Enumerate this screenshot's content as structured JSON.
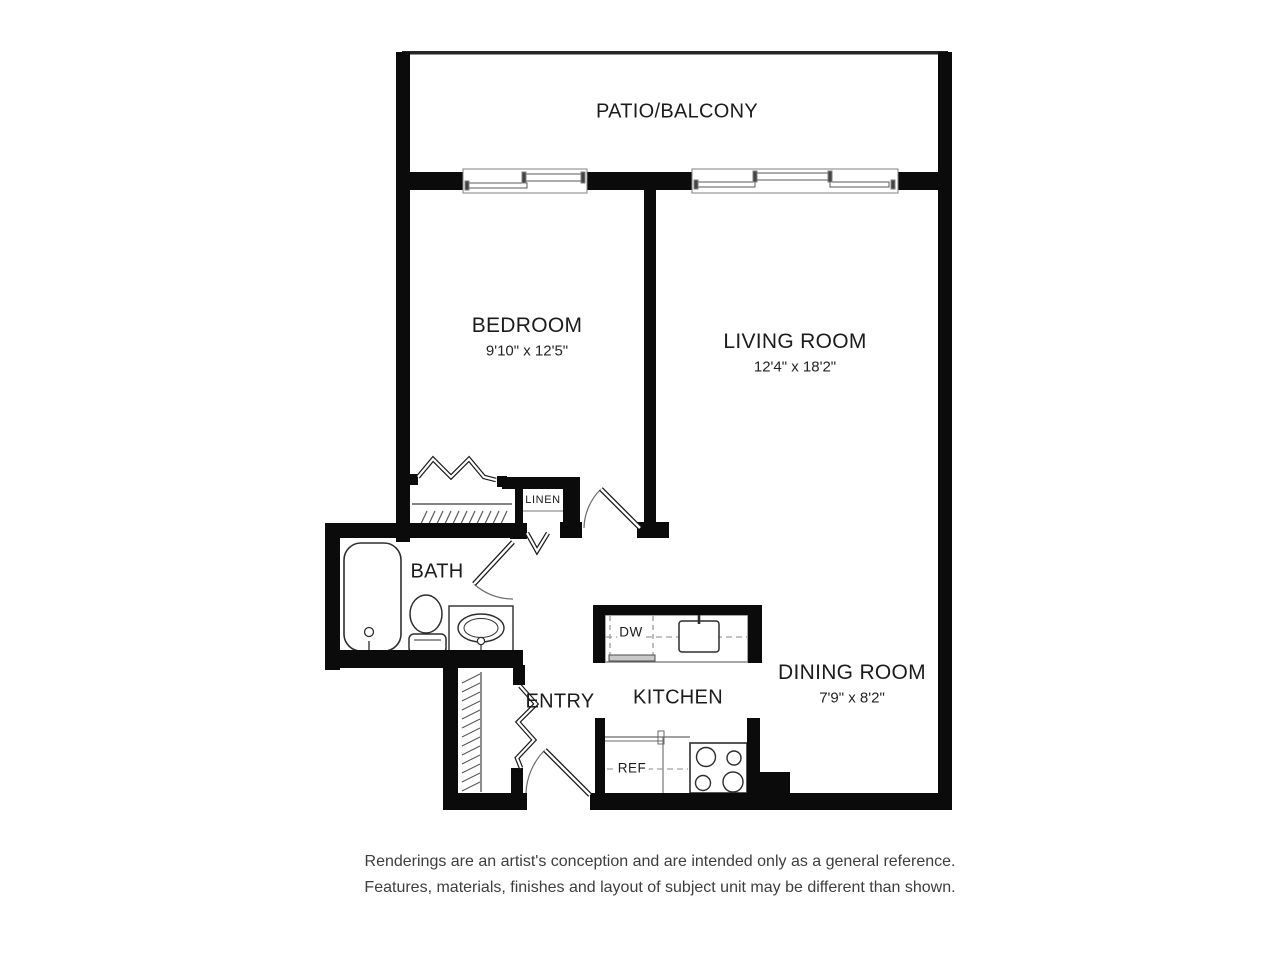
{
  "canvas": {
    "bg": "#ffffff",
    "wall": "#0b0b0b",
    "line": "#5a5a5a",
    "ink": "#2e2e2e",
    "label": "#1c1c1c",
    "note": "#3e3e3e"
  },
  "rooms": {
    "patio": {
      "label": "PATIO/BALCONY"
    },
    "bedroom": {
      "label": "BEDROOM",
      "dims": "9'10\" x 12'5\""
    },
    "living": {
      "label": "LIVING ROOM",
      "dims": "12'4\" x 18'2\""
    },
    "dining": {
      "label": "DINING ROOM",
      "dims": "7'9\" x 8'2\""
    },
    "bath": {
      "label": "BATH"
    },
    "entry": {
      "label": "ENTRY"
    },
    "kitchen": {
      "label": "KITCHEN"
    },
    "linen": {
      "label": "LINEN"
    }
  },
  "appliances": {
    "dishwasher": "DW",
    "refrigerator": "REF"
  },
  "disclaimer": {
    "line1": "Renderings are an artist's conception and are intended only as a general reference.",
    "line2": "Features, materials, finishes and layout of subject unit may be different than shown."
  }
}
